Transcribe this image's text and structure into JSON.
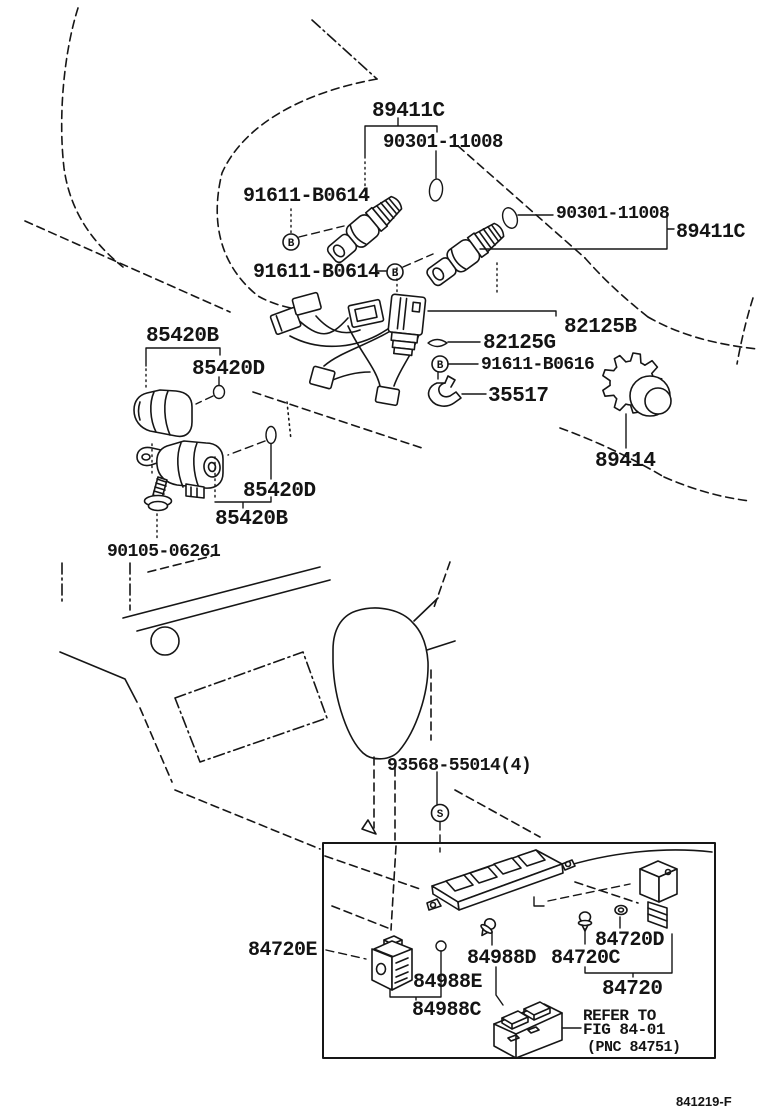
{
  "page": {
    "background": "#ffffff",
    "ink": "#141414"
  },
  "footer": {
    "drawing_code": "841219-F"
  },
  "symbols": {
    "bolt": "B",
    "screw": "S"
  },
  "callouts": {
    "c89411c_top": "89411C",
    "c90301_top": "90301-11008",
    "c91611b0614_a": "91611-B0614",
    "c90301_right": "90301-11008",
    "c89411c_right": "89411C",
    "c91611b0614_b": "91611-B0614",
    "c85420b_upper": "85420B",
    "c85420d_upper": "85420D",
    "c82125b": "82125B",
    "c82125g": "82125G",
    "c91611b0616": "91611-B0616",
    "c35517": "35517",
    "c89414": "89414",
    "c85420d_lower": "85420D",
    "c85420b_lower": "85420B",
    "c90105": "90105-06261",
    "c93568": "93568-55014(4)",
    "c84720e": "84720E",
    "c84988d": "84988D",
    "c84720c": "84720C",
    "c84720d": "84720D",
    "c84988e": "84988E",
    "c84720": "84720",
    "c84988c": "84988C",
    "refer_1": "REFER TO",
    "refer_2": "FIG 84-01",
    "refer_3": "(PNC 84751)"
  }
}
